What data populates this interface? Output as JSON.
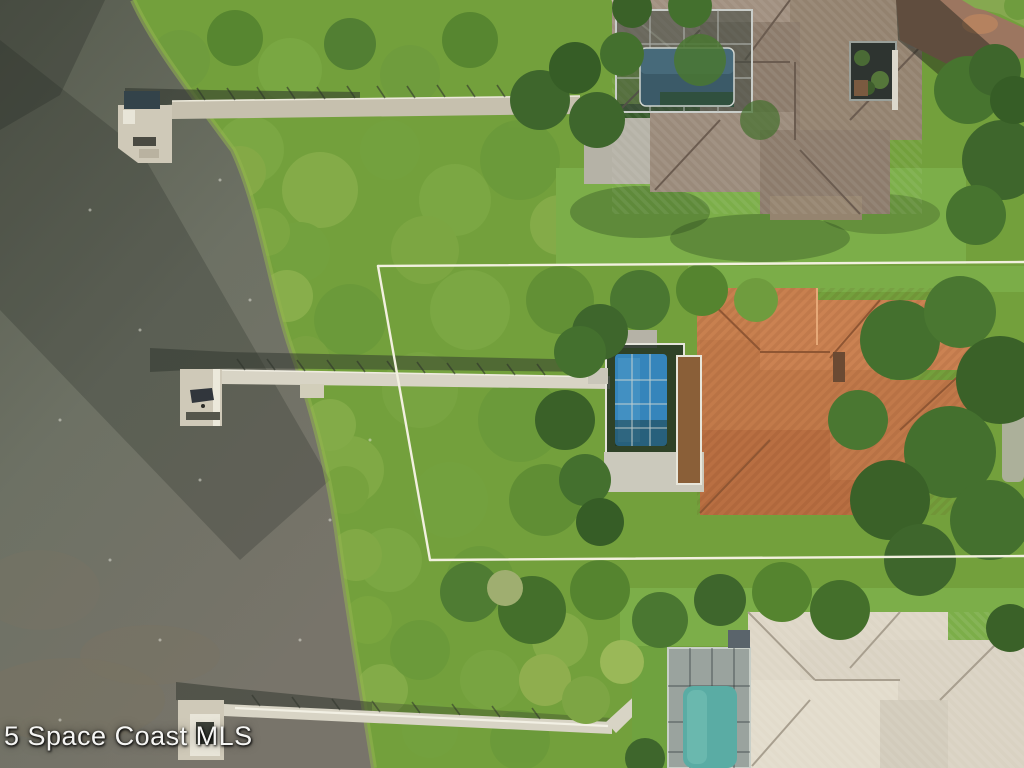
{
  "watermark": {
    "text": "5 Space Coast MLS"
  },
  "scene": {
    "type": "aerial-drone-photo",
    "subject": "waterfront-vacant-lot-with-property-boundary-overlay",
    "features": {
      "water": "lagoon",
      "docks": [
        "north-dock-with-boathouse",
        "center-dock-long-boardwalk",
        "south-dock-boardwalk"
      ],
      "houses": [
        "north-house-gray-tile-roof",
        "center-house-terracotta-roof",
        "south-house-cream-tile-roof"
      ],
      "pools": [
        "north-screened-pool",
        "center-screened-blue-pool",
        "south-screened-teal-pool"
      ],
      "overlay": "white-property-line-polygon"
    }
  },
  "palette": {
    "marsh": "#73a03c",
    "lawn": "#7cae49",
    "tree_dark": "#3e662c",
    "water_deep": "#565b4e",
    "water_mid": "#6d7164",
    "water_shallow": "#78746а",
    "water_shallow_fix": "#78746a",
    "dock": "#cfc9b8",
    "dock_shadow": "#2e332b",
    "roof_north": "#93826f",
    "roof_center": "#c27a4a",
    "roof_south": "#d9d2c2",
    "pool_north": "#3b5a68",
    "pool_center": "#3585bb",
    "pool_south": "#5aaca4",
    "driveway": "#9c7660",
    "property_line": "#f2f0df"
  }
}
